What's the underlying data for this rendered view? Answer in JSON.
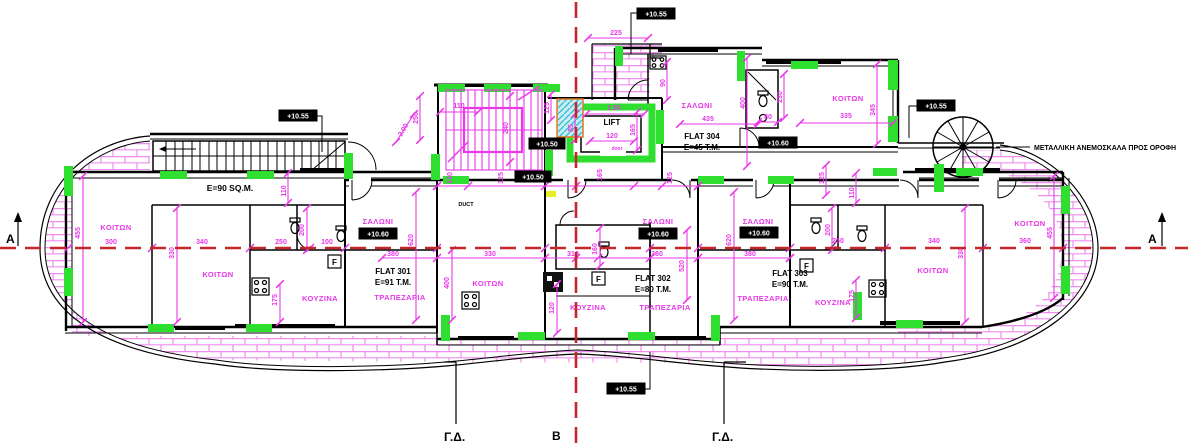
{
  "flats": [
    {
      "name": "FLAT 301",
      "area": "E=91 T.M."
    },
    {
      "name": "FLAT 302",
      "area": "E=80 T.M."
    },
    {
      "name": "FLAT 303",
      "area": "E=90 T.M."
    },
    {
      "name": "FLAT 304",
      "area": "E=45 T.M."
    }
  ],
  "labels": {
    "left_area": "E=90 SQ.M.",
    "bedroom": "ΚΟΙΤΩΝ",
    "living": "ΣΑΛΩΝΙ",
    "kitchen": "ΚΟΥΖΙΝΑ",
    "dining": "ΤΡΑΠΕΖΑΡΙΑ",
    "lift": "LIFT",
    "door": "door",
    "duct": "DUCT",
    "fridge": "F",
    "roof_ladder_note": "ΜΕΤΑΛΛΙΚΗ ΑΝΕΜΟΣΚΑΛΑ ΠΡΟΣ ΟΡΟΦΗ"
  },
  "levels": {
    "plus1050": "+10.50",
    "plus1055": "+10.55",
    "plus1060": "+10.60"
  },
  "axes": {
    "a": "A",
    "b": "B",
    "gd": "Γ.Δ."
  },
  "dims": {
    "v225": "225",
    "v110": "110",
    "v250": "250",
    "v2_00": "2.00",
    "v240": "240",
    "v125": "125",
    "v85": "85",
    "v1_95": "1.95",
    "v120": "120",
    "v165": "165",
    "v130": "130",
    "v90": "90",
    "v400": "400",
    "v435": "435",
    "v230": "230",
    "v80": "80",
    "v335": "335",
    "v345": "345",
    "v300": "300",
    "v455": "455",
    "v340": "340",
    "v330": "330",
    "v200": "200",
    "v100": "100",
    "v175": "175",
    "v380": "380",
    "v620": "620",
    "v310": "310",
    "v160": "160",
    "v360": "360",
    "v520": "520"
  },
  "colors": {
    "wall": "#000000",
    "dimension": "#e838e8",
    "column_highlight": "#2fdf2f",
    "section_axis": "#c3272b",
    "tile_hatch": "#f08df0",
    "stair_void_fill": "#c8edf5",
    "stair_void_border": "#e07820"
  }
}
